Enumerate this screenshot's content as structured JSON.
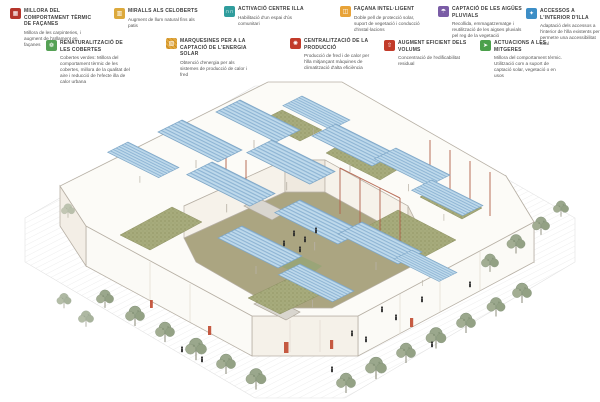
{
  "legend": {
    "items": [
      {
        "title": "MILLORA DEL COMPORTAMENT TÈRMIC DE FAÇANES",
        "desc": "Millora de les carpinteries, i augment de l'aïllament en façanes",
        "color": "#b5352b",
        "icon": "facade-thermal-icon",
        "glyph": "▦"
      },
      {
        "title": "MIRALLS ALS CELOBERTS",
        "desc": "Augment de llum natural fins als patis",
        "color": "#dca93c",
        "icon": "mirrors-icon",
        "glyph": "▥"
      },
      {
        "title": "ACTIVACIÓ CENTRE ILLA",
        "desc": "Habilitació d'un espai d'ús comunitari",
        "color": "#309d9d",
        "icon": "community-people-icon",
        "glyph": "∩∩"
      },
      {
        "title": "FAÇANA INTEL·LIGENT",
        "desc": "Doble pell de protecció solar, suport de vegetació i conducció d'instal·lacions",
        "color": "#e8a338",
        "icon": "smart-facade-icon",
        "glyph": "◫"
      },
      {
        "title": "CAPTACIÓ DE LES AIGÜES PLUVIALS",
        "desc": "Recollida, emmagatzematge i reutilització de les aigües pluvials pel reg de la vegetació",
        "color": "#7a5ca6",
        "icon": "rainwater-icon",
        "glyph": "☂"
      },
      {
        "title": "ACCESSOS A L'INTERIOR D'ILLA",
        "desc": "Adaptació dels accessos a l'interior de l'illa existents per permetre una accessibilitat total",
        "color": "#3d8ec6",
        "icon": "accessibility-icon",
        "glyph": "✦"
      },
      {
        "title": "RENATURALITZACIÓ DE LES COBERTES",
        "desc": "Cobertes verdes: Millora del comportament tèrmic de les cobertes, millora de la qualitat del aire i reducció de l'efecte illa de calor urbana",
        "color": "#55a155",
        "icon": "green-roof-icon",
        "glyph": "❁"
      },
      {
        "title": "MARQUESINES PER A LA CAPTACIÓ DE L'ENERGIA SOLAR",
        "desc": "Obtenció d'energia per als sistemes de producció de calor i fred",
        "color": "#e2a93f",
        "icon": "solar-canopy-icon",
        "glyph": "▨"
      },
      {
        "title": "CENTRALITZACIÓ DE LA PRODUCCIÓ",
        "desc": "Producció de fred i de calor per l'illa mitjançant màquines de climatització d'alta eficiència",
        "color": "#c23b2a",
        "icon": "central-production-icon",
        "glyph": "✺"
      },
      {
        "title": "AUGMENT EFICIENT DELS VOLUMS",
        "desc": "Concentració de l'edificabilitat residual",
        "color": "#c23b2a",
        "icon": "volume-increase-icon",
        "glyph": "⇧"
      },
      {
        "title": "ACTUACIONS A LES MITGERES",
        "desc": "Millora del comportament tèrmic. Utilització com a suport de captació solar, vegetació o en usos",
        "color": "#4ba04b",
        "icon": "party-wall-icon",
        "glyph": "➤"
      }
    ]
  },
  "scene": {
    "subject": "axonometric-city-block",
    "colors": {
      "solar_canopy": "#bed9eb",
      "canopy_stripe": "#8db4d4",
      "green_roof": "#a7ab7c",
      "courtyard_floor": "#aba581",
      "tree_foliage": "#9aa78c",
      "service_duct_red": "#b2604a",
      "building_outline": "#b7b0a5"
    }
  }
}
